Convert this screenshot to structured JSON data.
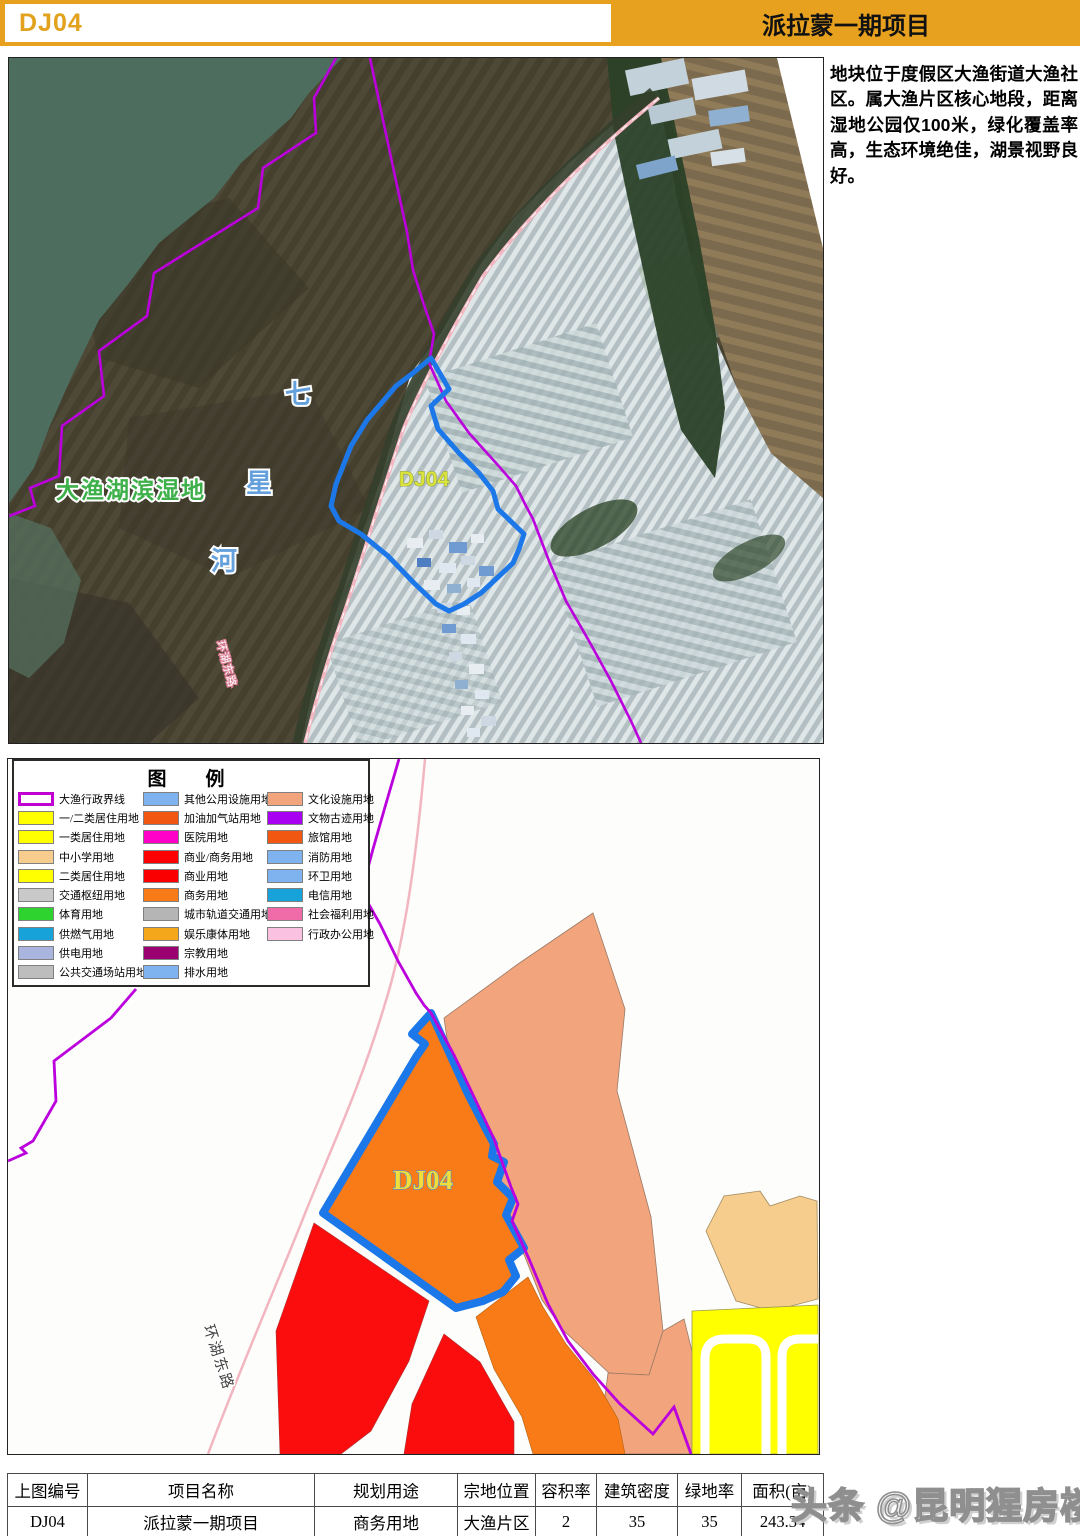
{
  "header": {
    "plot_code": "DJ04",
    "project_title": "派拉蒙一期项目"
  },
  "description": {
    "text": "地块位于度假区大渔街道大渔社区。属大渔片区核心地段，距离湿地公园仅100米，绿化覆盖率高，生态环境绝佳，湖景视野良好。"
  },
  "satellite_map": {
    "labels": {
      "wetland": "大渔湖滨湿地",
      "river_chars": [
        "七",
        "星",
        "河"
      ],
      "plot_code": "DJ04",
      "road": "环湖东路"
    }
  },
  "planning_map": {
    "plot_code": "DJ04",
    "road": "环湖东路"
  },
  "legend": {
    "title": "图　例",
    "columns": [
      [
        {
          "label": "大渔行政界线",
          "color": "#ffffff",
          "border": "#c000d0"
        },
        {
          "label": "一/二类居住用地",
          "color": "#ffff00"
        },
        {
          "label": "一类居住用地",
          "color": "#ffff00"
        },
        {
          "label": "中小学用地",
          "color": "#f6cd8d"
        },
        {
          "label": "二类居住用地",
          "color": "#ffff00"
        },
        {
          "label": "交通枢纽用地",
          "color": "#c9c9c9"
        },
        {
          "label": "体育用地",
          "color": "#2fd32f"
        },
        {
          "label": "供燃气用地",
          "color": "#18a2da"
        },
        {
          "label": "供电用地",
          "color": "#a9b5de"
        },
        {
          "label": "公共交通场站用地",
          "color": "#bdbdbd"
        }
      ],
      [
        {
          "label": "其他公用设施用地",
          "color": "#7fb3f0"
        },
        {
          "label": "加油加气站用地",
          "color": "#f25711"
        },
        {
          "label": "医院用地",
          "color": "#ff00c8"
        },
        {
          "label": "商业/商务用地",
          "color": "#ff0000"
        },
        {
          "label": "商业用地",
          "color": "#fa0000"
        },
        {
          "label": "商务用地",
          "color": "#f97b17"
        },
        {
          "label": "城市轨道交通用地",
          "color": "#b5b5b5"
        },
        {
          "label": "娱乐康体用地",
          "color": "#f5a71b"
        },
        {
          "label": "宗教用地",
          "color": "#9b0070"
        },
        {
          "label": "排水用地",
          "color": "#7fb3f0"
        }
      ],
      [
        {
          "label": "文化设施用地",
          "color": "#f2a47c"
        },
        {
          "label": "文物古迹用地",
          "color": "#a800f0"
        },
        {
          "label": "旅馆用地",
          "color": "#f25711"
        },
        {
          "label": "消防用地",
          "color": "#7fb3f0"
        },
        {
          "label": "环卫用地",
          "color": "#7fb3f0"
        },
        {
          "label": "电信用地",
          "color": "#18a2da"
        },
        {
          "label": "社会福利用地",
          "color": "#f06ca8"
        },
        {
          "label": "行政办公用地",
          "color": "#fac2e0"
        }
      ]
    ]
  },
  "table": {
    "headers": [
      "上图编号",
      "项目名称",
      "规划用途",
      "宗地位置",
      "容积率",
      "建筑密度",
      "绿地率",
      "面积(亩)"
    ],
    "rows": [
      [
        "DJ04",
        "派拉蒙一期项目",
        "商务用地",
        "大渔片区",
        "2",
        "35",
        "35",
        "243.34"
      ]
    ]
  },
  "watermark": {
    "text": "头条 @昆明猩房楼市"
  },
  "colors": {
    "header_orange": "#e7a11f",
    "admin_boundary_purple": "#bb00dd",
    "plot_outline_blue": "#1c78e8",
    "business_orange": "#f97b17",
    "commercial_red": "#fb0d0d",
    "culture_salmon": "#f2a47c",
    "school_wheat": "#f6cd8d",
    "residential_yellow": "#ffff00",
    "road_pink": "#f2b6c0",
    "lake_green": "#4d6e5f"
  }
}
